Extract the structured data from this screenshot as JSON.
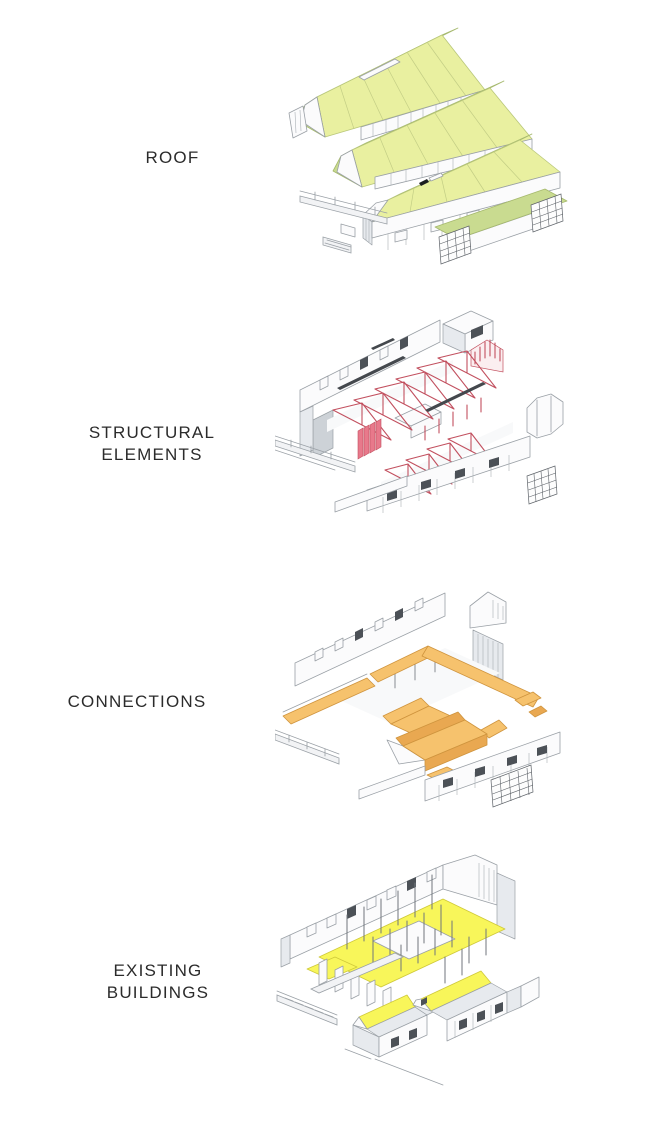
{
  "colors": {
    "background": "#ffffff",
    "label_ink": "#2b2b2b",
    "line": "#9aa0a6",
    "roof_green": "#e9f0a0",
    "roof_green_shade": "#c9db90",
    "truss_red": "#c2505f",
    "panel_red": "#e8798b",
    "connection_orange": "#f6c26d",
    "connection_orange_deep": "#e9a851",
    "orange_line": "#cf943e",
    "existing_yellow": "#f8f65a",
    "yellow_line": "#cfc93a",
    "wall_white": "#fbfbfc",
    "wall_shade": "#e7eaee",
    "slot_dark": "#4c5157",
    "grid_dark": "#5d6268"
  },
  "sections": [
    {
      "id": "roof",
      "label": "ROOF",
      "highlight_color": "#e9f0a0"
    },
    {
      "id": "structural-elements",
      "label": "STRUCTURAL ELEMENTS",
      "highlight_color": "#e8798b"
    },
    {
      "id": "connections",
      "label": "CONNECTIONS",
      "highlight_color": "#f6c26d"
    },
    {
      "id": "existing-buildings",
      "label": "EXISTING BUILDINGS",
      "highlight_color": "#f8f65a"
    }
  ]
}
